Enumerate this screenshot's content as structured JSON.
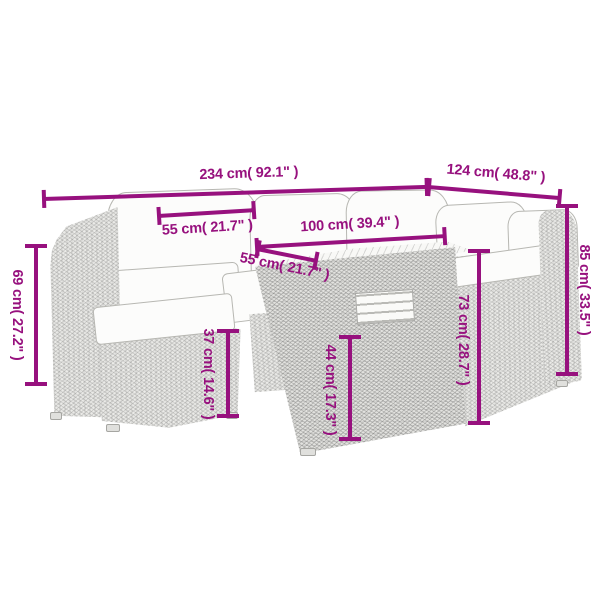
{
  "accent_color": "#97117E",
  "dims": {
    "total_width": "234 cm( 92.1\" )",
    "right_depth": "124 cm( 48.8\" )",
    "seat_width": "55 cm( 21.7\" )",
    "table_length": "100 cm( 39.4\" )",
    "table_depth": "55 cm( 21.7\" )",
    "left_back_height": "69 cm( 27.2\" )",
    "seat_height": "37 cm( 14.6\" )",
    "table_front_height": "44 cm( 17.3\" )",
    "table_height": "73 cm( 28.7\" )",
    "back_height": "85 cm( 33.5\" )"
  }
}
